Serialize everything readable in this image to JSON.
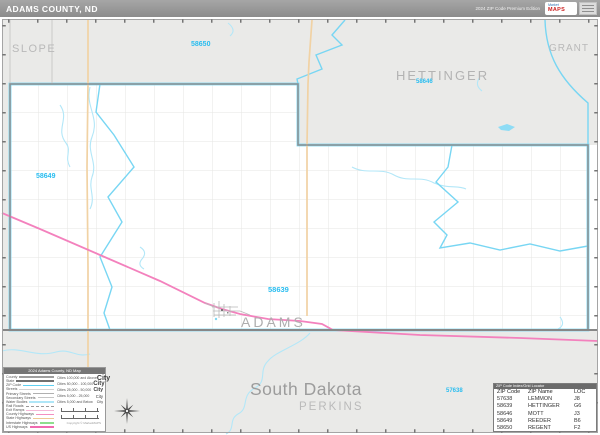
{
  "header": {
    "title": "ADAMS COUNTY, ND",
    "edition": "2024 ZIP Code Premium Edition",
    "logo_market": "Market",
    "logo_maps": "MAPS"
  },
  "map": {
    "neighbor_labels": {
      "slope": "SLOPE",
      "hettinger": "HETTINGER",
      "grant": "GRANT",
      "perkins": "PERKINS"
    },
    "state_label": "South Dakota",
    "county_label": "ADAMS",
    "zip_labels": {
      "z58650": "58650",
      "z58646": "58646",
      "z58649": "58649",
      "z58639": "58639",
      "z57638": "57638"
    }
  },
  "legend": {
    "title": "2024 Adams County, ND Map",
    "items": [
      {
        "label": "County"
      },
      {
        "label": "State"
      },
      {
        "label": "ZIP Code"
      },
      {
        "label": "Streets"
      },
      {
        "label": "Primary Streets"
      },
      {
        "label": "Secondary Streets"
      },
      {
        "label": "Water Bodies"
      },
      {
        "label": "Rail Roads"
      },
      {
        "label": "Exit Ramps"
      },
      {
        "label": "County Highways"
      },
      {
        "label": "State Highways"
      },
      {
        "label": "Interstate Highways"
      },
      {
        "label": "US Highways"
      }
    ],
    "cities": [
      {
        "label": "Cities 100,000 and Above",
        "sample": "City"
      },
      {
        "label": "Cities 50,000 - 100,000",
        "sample": "City"
      },
      {
        "label": "Cities 25,000 - 50,000",
        "sample": "City"
      },
      {
        "label": "Cities 5,000 - 25,000",
        "sample": "City"
      },
      {
        "label": "Cities 5,000 and Below",
        "sample": "City"
      }
    ],
    "copyright": "Copyright © MarketMAPS"
  },
  "zip_table": {
    "title": "ZIP Code Index/Grid Locator",
    "columns": [
      "ZIP Code",
      "ZIP Name",
      "LOC"
    ],
    "rows": [
      [
        "57638",
        "LEMMON",
        "J8"
      ],
      [
        "58639",
        "HETTINGER",
        "G6"
      ],
      [
        "58646",
        "MOTT",
        "J3"
      ],
      [
        "58649",
        "REEDER",
        "B6"
      ],
      [
        "58650",
        "REGENT",
        "F2"
      ]
    ]
  },
  "colors": {
    "zip_boundary": "#78d6f3",
    "zip_label": "#29bdf0",
    "us_highway_pink": "#f381bd",
    "state_highway_tan": "#f1d2a4",
    "county_line": "#8f8f8f",
    "neighbor_fill": "#eaeae8",
    "label_gray": "#b3b3b3"
  }
}
